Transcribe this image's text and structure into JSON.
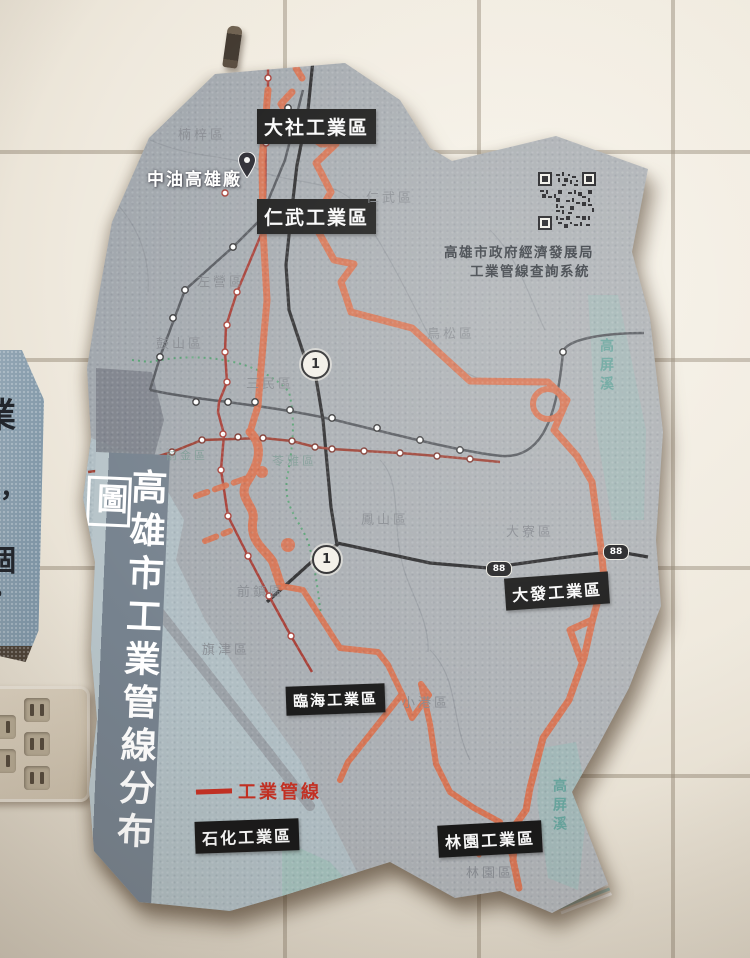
{
  "wall": {
    "side_poster_fragments": [
      "業",
      "，",
      "個",
      "。"
    ]
  },
  "poster": {
    "title_vertical_main": "高雄市工業管線分布",
    "title_vertical_boxed": "圖",
    "plant_label": "中油高雄廠",
    "qr_caption_line1": "高雄市政府經濟發展局",
    "qr_caption_line2": "工業管線查詢系統",
    "legend_pipeline_label": "工業管線",
    "industrial_parks": [
      "大社工業區",
      "仁武工業區",
      "大發工業區",
      "臨海工業區",
      "石化工業區",
      "林園工業區"
    ],
    "districts": [
      "楠梓區",
      "仁武區",
      "左營區",
      "鼓山區",
      "三民區",
      "鳥松區",
      "前金區",
      "苓雅區",
      "鳳山區",
      "大寮區",
      "前鎮區",
      "旗津區",
      "小港區",
      "林園區"
    ],
    "river_label_upper": "高屏溪",
    "river_label_lower": "高屏溪",
    "highway1_label": "1",
    "highway88_label": "88",
    "colors": {
      "pipeline_orange": "#d96f4c",
      "legend_red": "#c43023",
      "mrt_red": "#a63c34",
      "rail_gray": "#55585e",
      "highway_black": "#2c2c2e",
      "lightrail_green": "#57a173",
      "water_teal": "#93bdb8",
      "poster_gray": "#a6abb0",
      "label_box_black": "#191919"
    }
  }
}
